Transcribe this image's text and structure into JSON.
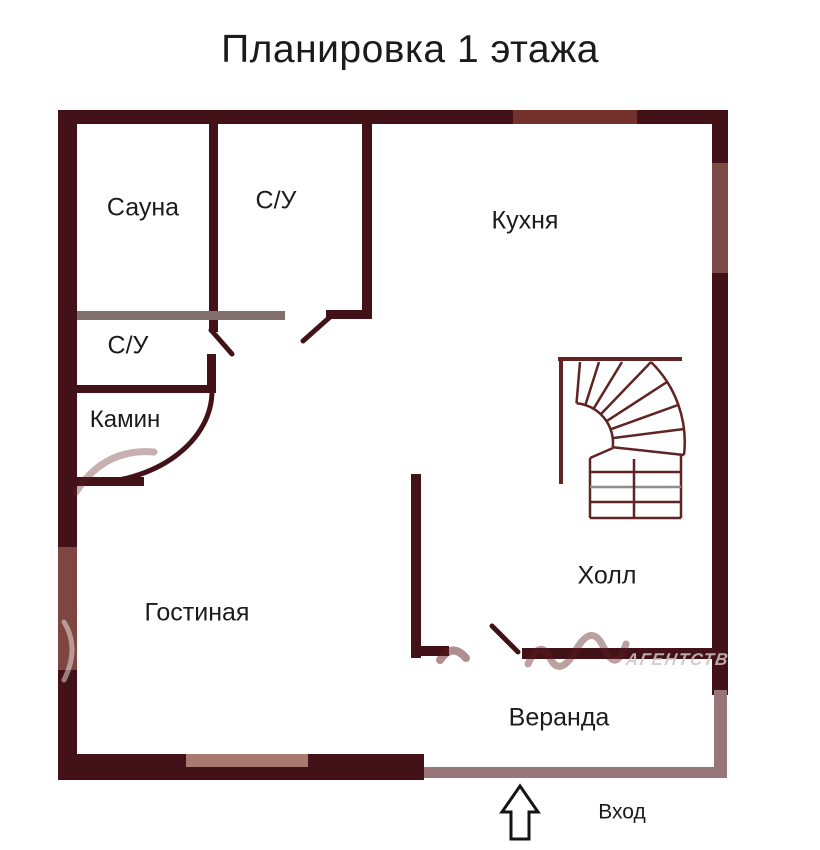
{
  "title": "Планировка 1 этажа",
  "rooms": [
    {
      "id": "sauna",
      "label": "Сауна"
    },
    {
      "id": "bathroom-top",
      "label": "С/У"
    },
    {
      "id": "kitchen",
      "label": "Кухня"
    },
    {
      "id": "bathroom-left",
      "label": "С/У"
    },
    {
      "id": "fireplace",
      "label": "Камин"
    },
    {
      "id": "living-room",
      "label": "Гостиная"
    },
    {
      "id": "hall",
      "label": "Холл"
    },
    {
      "id": "veranda",
      "label": "Веранда"
    }
  ],
  "entrance": {
    "label": "Вход",
    "icon": "up-arrow-icon"
  },
  "staircase": {
    "type": "quarter-turn-winder-stairs"
  },
  "watermark": {
    "text": "АГЕНТСТВ"
  },
  "colors": {
    "background": "#ffffff",
    "wall_dark": "#431118",
    "wall_gray": "#81706c",
    "veranda_wall": "#98757b",
    "window_top": "#74312c",
    "window_left": "#7f4541",
    "window_right": "#7d4b45",
    "window_bottom": "#a8796f",
    "stair_stroke": "#5f2423",
    "text": "#1b1b1b"
  }
}
